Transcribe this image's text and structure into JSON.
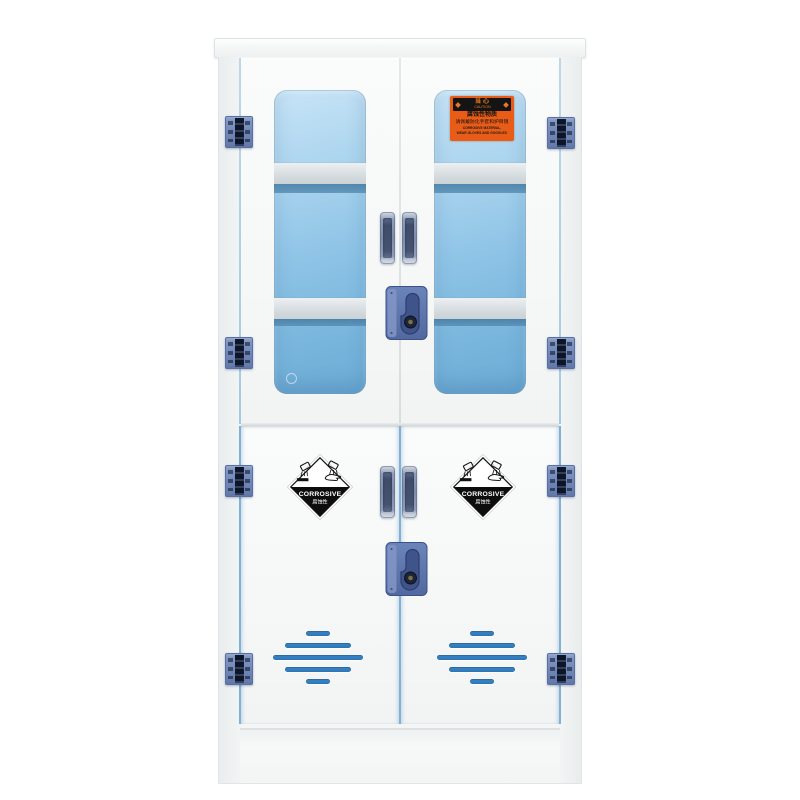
{
  "colors": {
    "background": "#ffffff",
    "cabinet_body": "#f4f6f6",
    "door_panel": "#f8f9f9",
    "seam_blue": "#7fb2d8",
    "glass_top": "#b9ddf3",
    "glass_bottom": "#6cacd6",
    "shelf_band": "#d7dde0",
    "shelf_shadow": "#467ba4",
    "hinge_blue": "#7288b8",
    "hinge_dark": "#0d1526",
    "handle_dark": "#46536f",
    "lock_blue": "#5b76ad",
    "vent_blue": "#2e7bc0",
    "label_orange": "#e85c17",
    "label_black": "#141414"
  },
  "caution_label": {
    "band_title": "当心",
    "band_subtitle": "CAUTION",
    "line1": "腐蚀性物质",
    "line2": "请佩戴防化手套和护目镜",
    "line3": "CORROSIVE MATERIAL,",
    "line4": "WEAR GLOVES AND GOGGLES"
  },
  "corrosive_label": {
    "title": "CORROSIVE",
    "subtitle": "腐蚀性"
  }
}
